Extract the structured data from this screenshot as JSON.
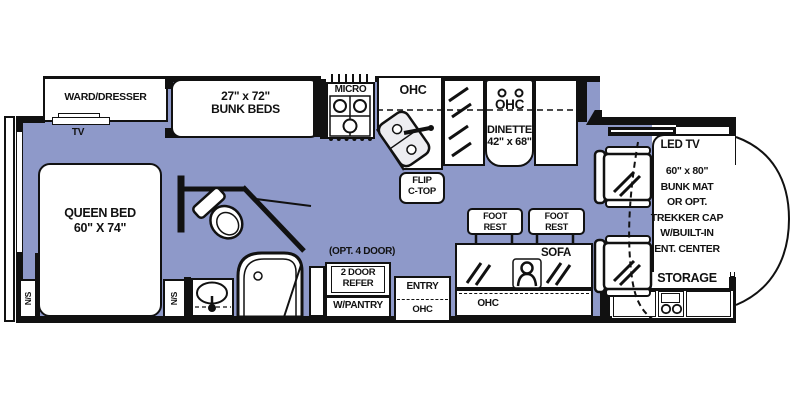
{
  "colors": {
    "floor": "#8e99c9",
    "wall": "#111111"
  },
  "bedroom": {
    "ward_dresser": "WARD/DRESSER",
    "tv": "TV",
    "queen_bed_line1": "QUEEN BED",
    "queen_bed_line2": "60\" X 74\"",
    "nightstand_left": "N/S",
    "nightstand_right": "N/S"
  },
  "bunkroom": {
    "line1": "27\" x 72\"",
    "line2": "BUNK BEDS"
  },
  "kitchen": {
    "micro": "MICRO",
    "ohc": "OHC",
    "flip_line1": "FLIP",
    "flip_line2": "C-TOP"
  },
  "dinette": {
    "ohc": "OHC",
    "name": "DINETTE",
    "size": "42\" x 68\""
  },
  "bathroom": {
    "shower": "SHOWER"
  },
  "pantry": {
    "opt": "(OPT. 4 DOOR)",
    "refer_line1": "2 DOOR",
    "refer_line2": "REFER",
    "pantry": "W/PANTRY"
  },
  "entryway": {
    "entry": "ENTRY",
    "ohc": "OHC"
  },
  "living": {
    "foot_rest_left_line1": "FOOT",
    "foot_rest_left_line2": "REST",
    "foot_rest_right_line1": "FOOT",
    "foot_rest_right_line2": "REST",
    "sofa": "SOFA",
    "ohc": "OHC"
  },
  "cab": {
    "led_tv": "LED TV",
    "bunk_mat": [
      "60\" x 80\"",
      "BUNK MAT",
      "OR OPT.",
      "TREKKER CAP",
      "W/BUILT-IN",
      "ENT. CENTER"
    ],
    "storage": "STORAGE"
  }
}
